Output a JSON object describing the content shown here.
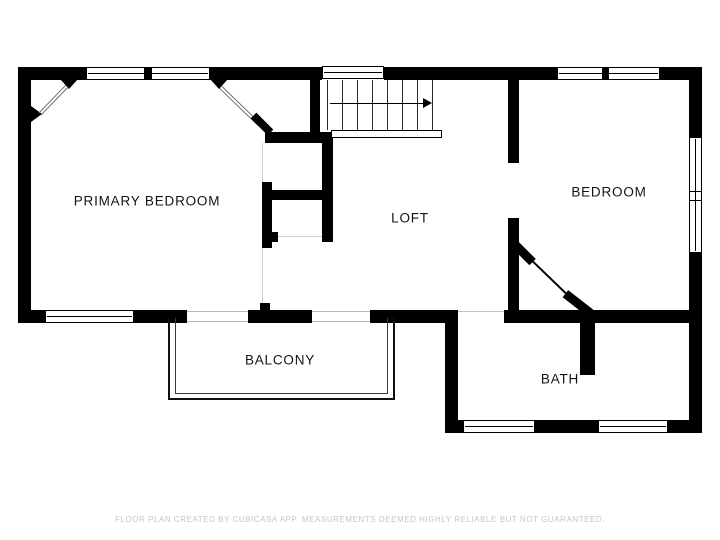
{
  "plan": {
    "type": "floor-plan",
    "rooms": [
      {
        "id": "primary-bedroom",
        "label": "PRIMARY BEDROOM"
      },
      {
        "id": "loft",
        "label": "LOFT"
      },
      {
        "id": "bedroom",
        "label": "BEDROOM"
      },
      {
        "id": "balcony",
        "label": "BALCONY"
      },
      {
        "id": "bath",
        "label": "BATH"
      }
    ],
    "stairs": {
      "direction": "right",
      "treads": 7
    },
    "footer": "FLOOR PLAN CREATED BY CUBICASA APP. MEASUREMENTS DEEMED HIGHLY RELIABLE BUT NOT GUARANTEED."
  },
  "colors": {
    "wall": "#000000",
    "background": "#ffffff",
    "footer_text": "#c6c6c6",
    "ceiling_line": "#6e6e6e"
  }
}
